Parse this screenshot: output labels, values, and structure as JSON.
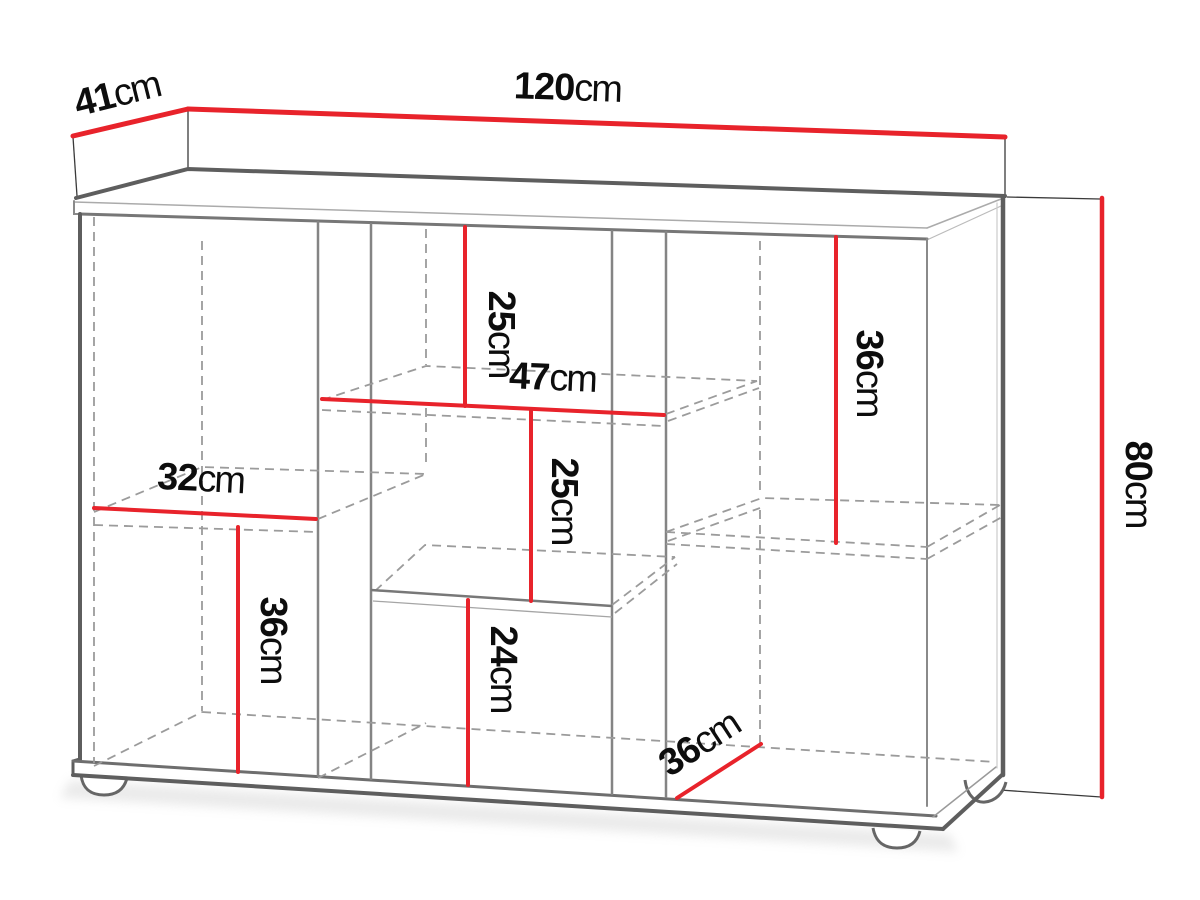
{
  "diagram": {
    "type": "furniture-dimension-diagram",
    "product": "sideboard with shelves",
    "unit": "cm",
    "overall": {
      "width_cm": 120,
      "depth_cm": 41,
      "height_cm": 80
    },
    "labels": {
      "width": {
        "value": "120",
        "unit": "cm"
      },
      "depth": {
        "value": "41",
        "unit": "cm"
      },
      "height": {
        "value": "80",
        "unit": "cm"
      },
      "top_middle_drop": {
        "value": "25",
        "unit": "cm"
      },
      "middle_section_width": {
        "value": "47",
        "unit": "cm"
      },
      "middle_shelf_drop": {
        "value": "25",
        "unit": "cm"
      },
      "right_shelf_drop": {
        "value": "36",
        "unit": "cm"
      },
      "left_shelf_width": {
        "value": "32",
        "unit": "cm"
      },
      "left_lower_height": {
        "value": "36",
        "unit": "cm"
      },
      "bottom_middle_height": {
        "value": "24",
        "unit": "cm"
      },
      "interior_depth": {
        "value": "36",
        "unit": "cm"
      }
    },
    "colors": {
      "dimension_red": "#e8232b",
      "outline_dark": "#5e5e5e",
      "partition_gray": "#848484",
      "dashed_gray": "#9b9b9b",
      "text": "#0d0d0d",
      "background": "#ffffff"
    }
  }
}
